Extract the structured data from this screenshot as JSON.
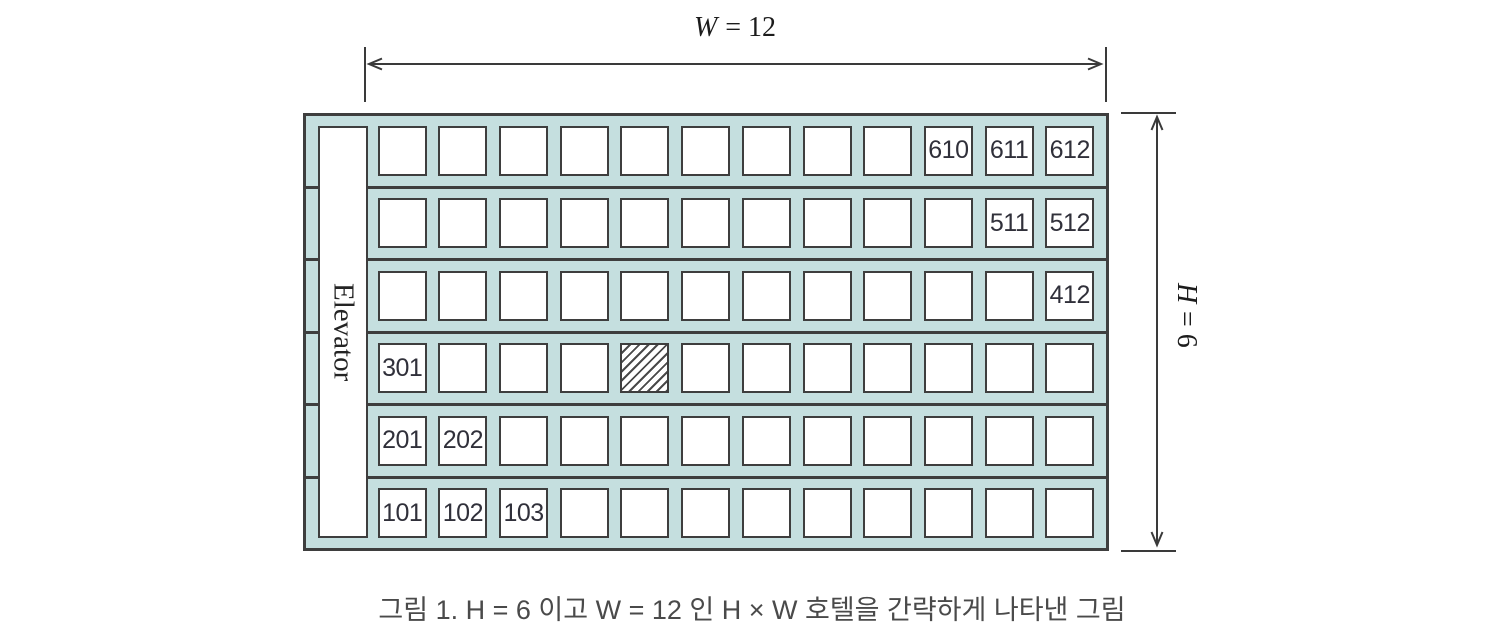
{
  "figure": {
    "width_label": {
      "symbol": "W",
      "rest": "= 12"
    },
    "height_label": {
      "symbol": "H",
      "rest": "= 6"
    },
    "elevator_label": "Elevator",
    "caption": "그림 1. H = 6 이고 W = 12 인 H × W 호텔을 간략하게 나타낸 그림"
  },
  "colors": {
    "building_fill": "#c5dfdf",
    "line_dark": "#3e3e3e",
    "room_fill": "#ffffff"
  },
  "hotel": {
    "floors_count": 6,
    "rooms_per_floor": 12,
    "floors": [
      {
        "floor": 6,
        "labels": [
          "",
          "",
          "",
          "",
          "",
          "",
          "",
          "",
          "",
          "610",
          "611",
          "612"
        ],
        "hatched_index": null
      },
      {
        "floor": 5,
        "labels": [
          "",
          "",
          "",
          "",
          "",
          "",
          "",
          "",
          "",
          "",
          "511",
          "512"
        ],
        "hatched_index": null
      },
      {
        "floor": 4,
        "labels": [
          "",
          "",
          "",
          "",
          "",
          "",
          "",
          "",
          "",
          "",
          "",
          "412"
        ],
        "hatched_index": null
      },
      {
        "floor": 3,
        "labels": [
          "301",
          "",
          "",
          "",
          "",
          "",
          "",
          "",
          "",
          "",
          "",
          ""
        ],
        "hatched_index": 4
      },
      {
        "floor": 2,
        "labels": [
          "201",
          "202",
          "",
          "",
          "",
          "",
          "",
          "",
          "",
          "",
          "",
          ""
        ],
        "hatched_index": null
      },
      {
        "floor": 1,
        "labels": [
          "101",
          "102",
          "103",
          "",
          "",
          "",
          "",
          "",
          "",
          "",
          "",
          ""
        ],
        "hatched_index": null
      }
    ]
  }
}
